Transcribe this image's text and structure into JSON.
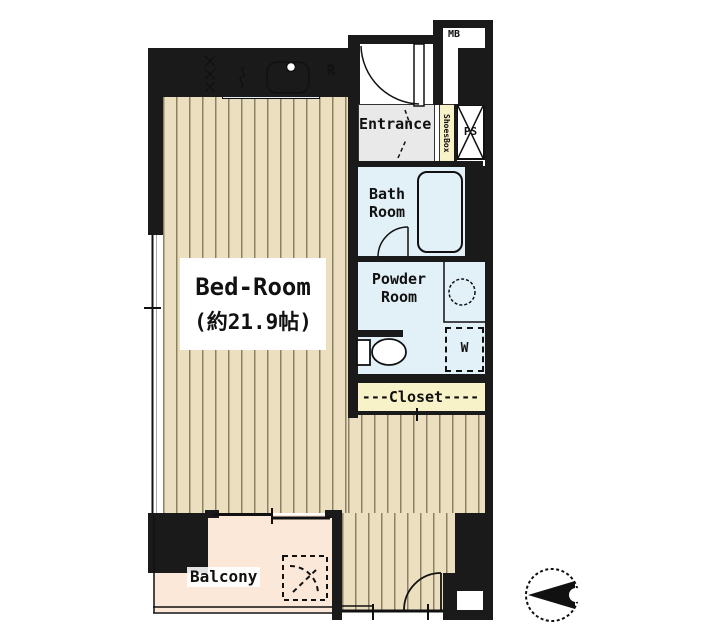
{
  "title": "apartment floor plan",
  "colors": {
    "wall": "#1a1a1a",
    "floor": "#ecdfc0",
    "floor-stripe": "#8c8066",
    "water": "#e2f1f7",
    "balcony": "#fbe8d8",
    "closet": "#f8f2c9",
    "entrance-floor": "#e9e9e9",
    "line": "#1a1a1a"
  },
  "rooms": {
    "bedroom": {
      "name": "Bed-Room",
      "size": "(約21.9帖)"
    },
    "entrance": {
      "label": "Entrance"
    },
    "bath": {
      "line1": "Bath",
      "line2": "Room"
    },
    "powder": {
      "line1": "Powder",
      "line2": "Room"
    },
    "closet": {
      "label": "---Closet----"
    },
    "balcony": {
      "label": "Balcony"
    }
  },
  "fixtures": {
    "meter_box": "MB",
    "pipe_shaft": "PS",
    "shoes_box": "ShoesBox",
    "refrigerator": "R",
    "washer": "W"
  }
}
